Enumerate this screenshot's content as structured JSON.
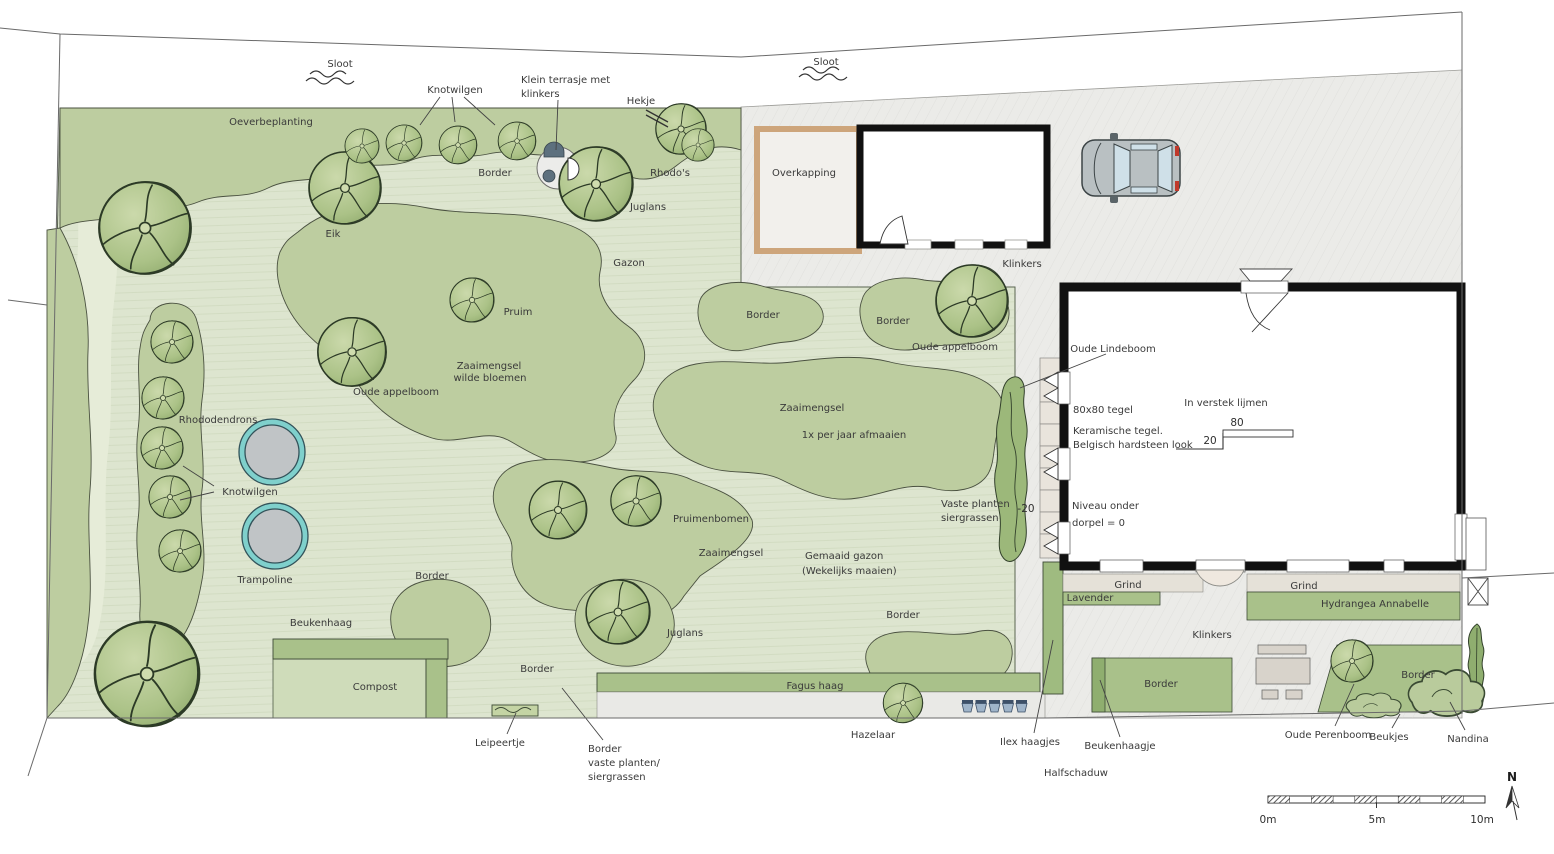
{
  "plan": {
    "title": "Tuinontwerp plattegrond",
    "labels": {
      "sloot_left": "Sloot",
      "sloot_right": "Sloot",
      "knotwilgen_top": "Knotwilgen",
      "klein_terrasje_1": "Klein terrasje met",
      "klein_terrasje_2": "klinkers",
      "hekje": "Hekje",
      "oeverbeplanting": "Oeverbeplanting",
      "rhodos": "Rhodo's",
      "border_top": "Border",
      "juglans_top": "Juglans",
      "eik": "Eik",
      "overkapping": "Overkapping",
      "klinkers_top": "Klinkers",
      "gazon": "Gazon",
      "pruim": "Pruim",
      "zaaimengsel_wilde_1": "Zaaimengsel",
      "zaaimengsel_wilde_2": "wilde bloemen",
      "oude_appelboom_left": "Oude appelboom",
      "border_mid_left": "Border",
      "border_mid_right": "Border",
      "oude_appelboom_right": "Oude appelboom",
      "zaaimengsel_mid": "Zaaimengsel",
      "afmaaien": "1x per jaar afmaaien",
      "rhododendrons": "Rhododendrons",
      "knotwilgen_left": "Knotwilgen",
      "trampoline": "Trampoline",
      "oude_lindeboom": "Oude Lindeboom",
      "tegel_80": "80x80 tegel",
      "keramische_1": "Keramische tegel.",
      "keramische_2": "Belgisch hardsteen look",
      "verstek": "In verstek lijmen",
      "dim_80": "80",
      "dim_20": "20",
      "dim_min20": "-20",
      "niveau_1": "Niveau onder",
      "niveau_2": "dorpel = 0",
      "vaste_planten_1": "Vaste planten",
      "vaste_planten_2": "siergrassen",
      "pruimenbomen": "Pruimenbomen",
      "zaaimengsel_low": "Zaaimengsel",
      "gemaaid_1": "Gemaaid gazon",
      "gemaaid_2": "(Wekelijks maaien)",
      "border_gazon": "Border",
      "juglans_low": "Juglans",
      "border_left_low": "Border",
      "beukenhaag": "Beukenhaag",
      "compost": "Compost",
      "border_mid_low": "Border",
      "leipeertje": "Leipeertje",
      "fagus_haag": "Fagus haag",
      "border_vp_1": "Border",
      "border_vp_2": "vaste planten/",
      "border_vp_3": "siergrassen",
      "hazelaar": "Hazelaar",
      "ilex_haagjes": "Ilex haagjes",
      "beukenhaagje": "Beukenhaagje",
      "halfschaduw": "Halfschaduw",
      "border_block": "Border",
      "grind_left": "Grind",
      "lavender": "Lavender",
      "grind_right": "Grind",
      "hydrangea": "Hydrangea Annabelle",
      "klinkers_mid": "Klinkers",
      "border_right_low": "Border",
      "oude_perenboom": "Oude Perenboom",
      "beukjes": "Beukjes",
      "nandina": "Nandina"
    },
    "scalebar": {
      "start": "0m",
      "middle": "5m",
      "end": "10m"
    },
    "compass": {
      "label": "N"
    },
    "colors": {
      "lawn": "#dde5cf",
      "bed": "#bdcda0",
      "hedge": "#a9c18a",
      "dark_hedge": "#8fae6f",
      "driveway": "#ebebe8",
      "gravel": "#e5e1d8",
      "trampoline_ring": "#7fd0cc",
      "trampoline_mat": "#c0c4c6",
      "overkapping_frame": "#cda57b",
      "pot_blue": "#9fb4c9",
      "taillight_red": "#c0392b",
      "wall_black": "#111111"
    }
  }
}
